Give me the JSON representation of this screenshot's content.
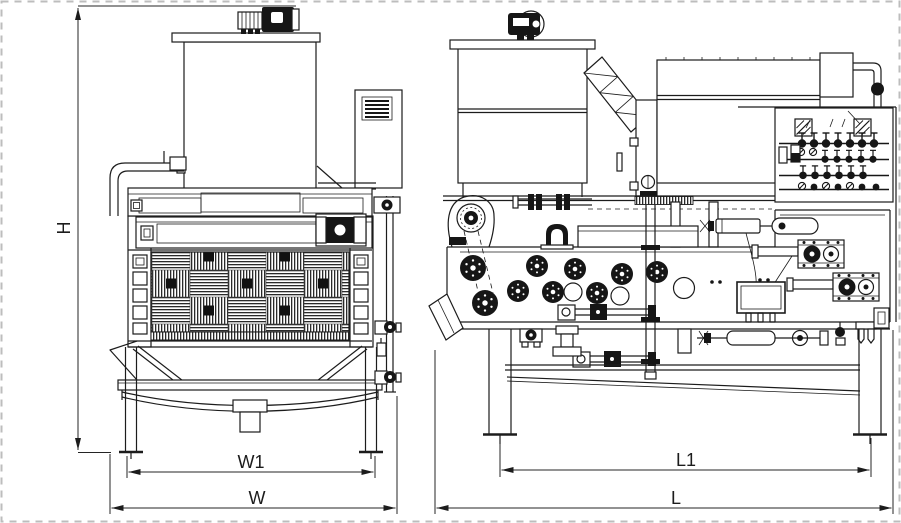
{
  "drawing": {
    "kind": "engineering-dimension-drawing",
    "subject": "belt filter press, front and side orthographic views",
    "colors": {
      "line": "#1c1c1c",
      "background": "#ffffff",
      "selection_dash": "#bdbdbd"
    },
    "dimension_labels": {
      "H": "H",
      "W1": "W1",
      "W": "W",
      "L1": "L1",
      "L": "L"
    }
  }
}
